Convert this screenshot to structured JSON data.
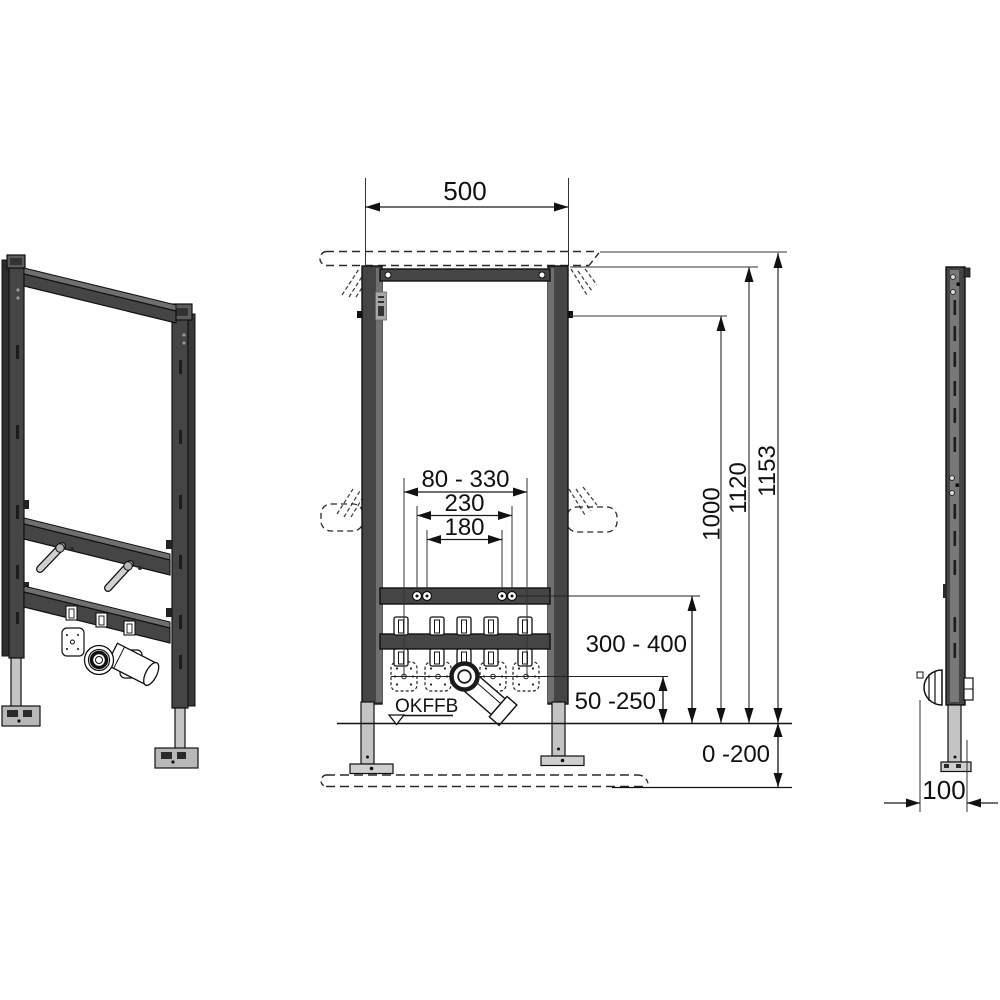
{
  "page": {
    "background": "#ffffff"
  },
  "drawing": {
    "views": [
      "perspective",
      "front",
      "side"
    ]
  },
  "dimensions": {
    "top_width": "500",
    "connection_range": "80 - 330",
    "bolt_spacing_outer": "230",
    "bolt_spacing_inner": "180",
    "height_upper_fixing": "1000",
    "height_frame_top": "1120",
    "height_total": "1153",
    "stud_height_range": "300 - 400",
    "outlet_height_range": "50 -250",
    "floor_buildup_range": "0 -200",
    "frame_depth": "100"
  },
  "labels": {
    "finished_floor_level": "OKFFB"
  },
  "colors": {
    "frame_dark": "#454545",
    "frame_mid": "#6f6f6f",
    "foot_gray": "#c4c4c4",
    "line_black": "#1a1a1a",
    "background": "#ffffff"
  }
}
